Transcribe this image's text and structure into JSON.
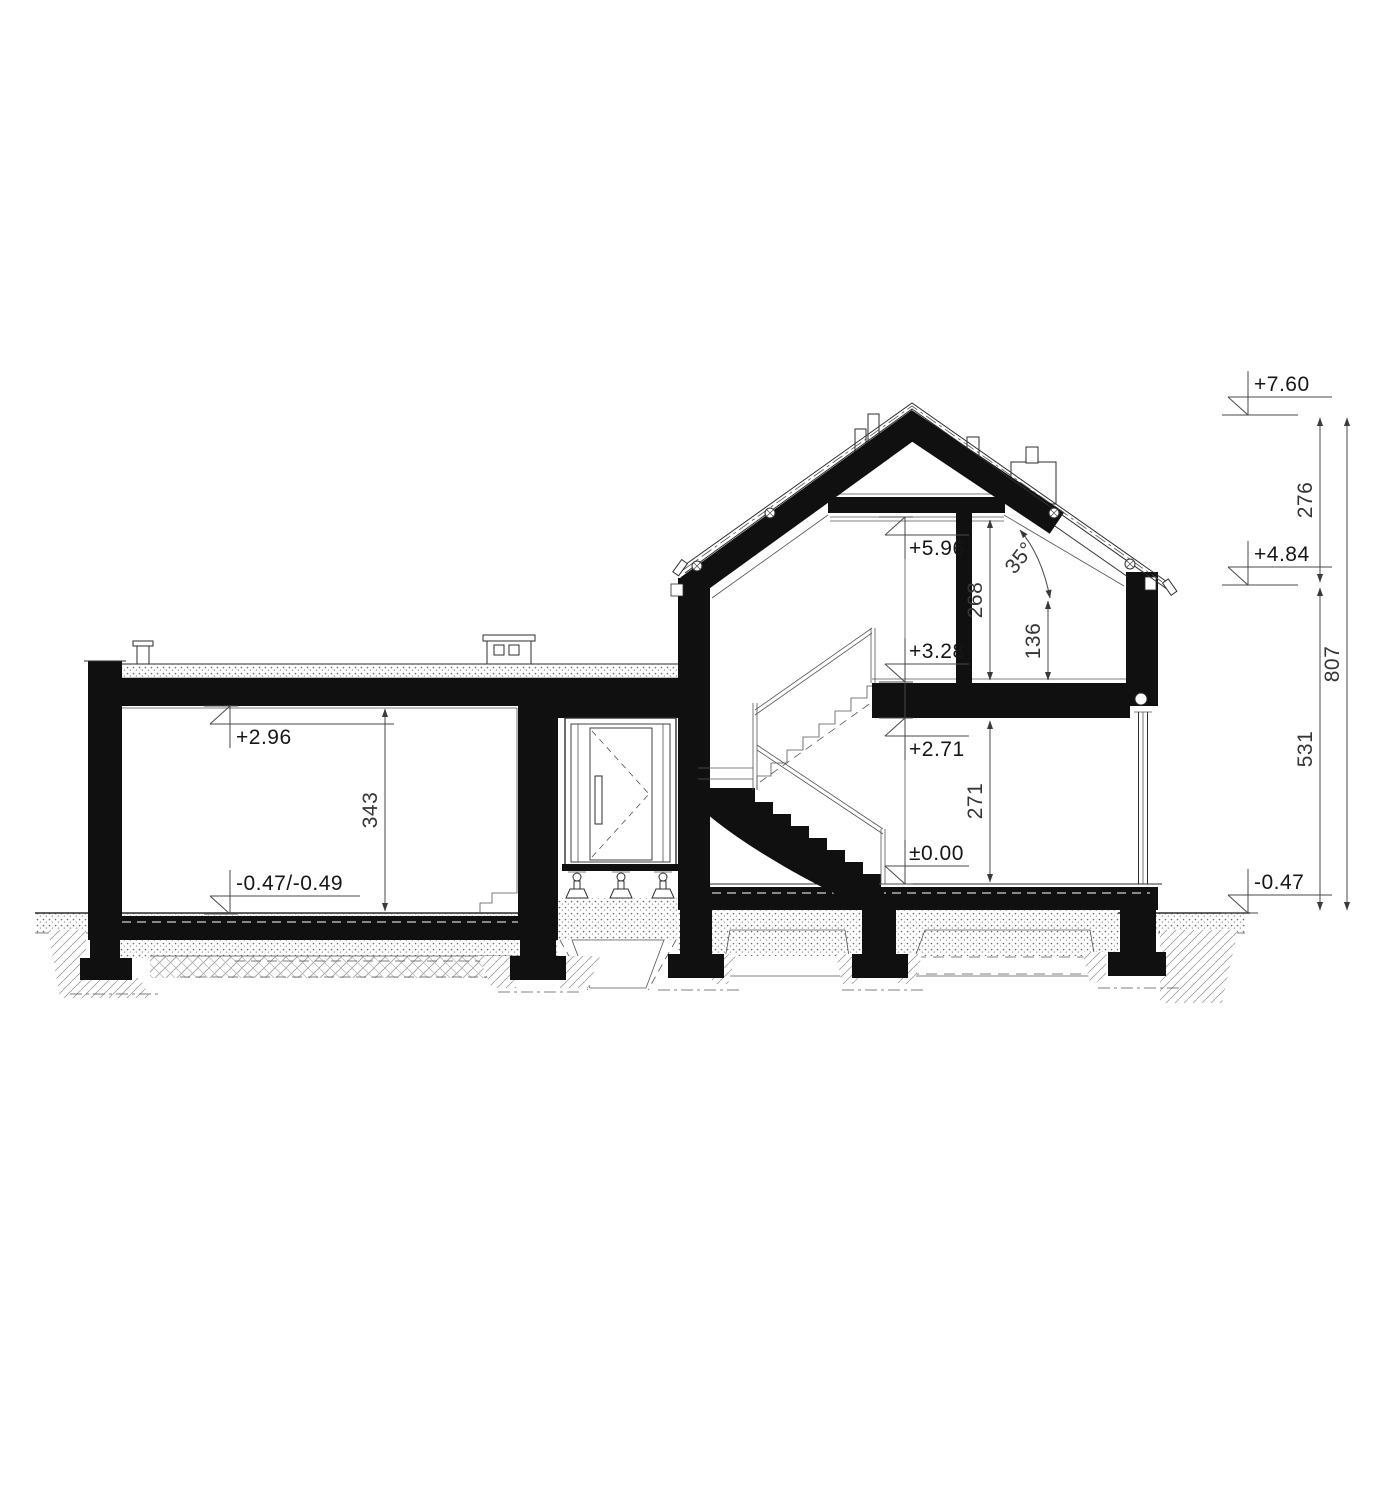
{
  "drawing": {
    "kind": "house-cross-section",
    "ink_color": "#101010",
    "annotation_color": "#353535"
  },
  "annotations": {
    "levels": {
      "ridge": "+7.60",
      "eaves": "+4.84",
      "terrain_right": "-0.47",
      "collar": "+5.96",
      "attic_floor": "+3.28",
      "ground_ceiling": "+2.71",
      "ground_floor": "±0.00",
      "garage_ceiling": "+2.96",
      "garage_floor": "-0.47/-0.49"
    },
    "dimensions": {
      "ridge_to_eaves": "276",
      "eaves_to_terrain": "531",
      "total_height": "807",
      "attic_room_height": "268",
      "knee_wall": "136",
      "ground_floor_height": "271",
      "garage_room_height": "343",
      "roof_pitch_angle": "35°"
    }
  }
}
